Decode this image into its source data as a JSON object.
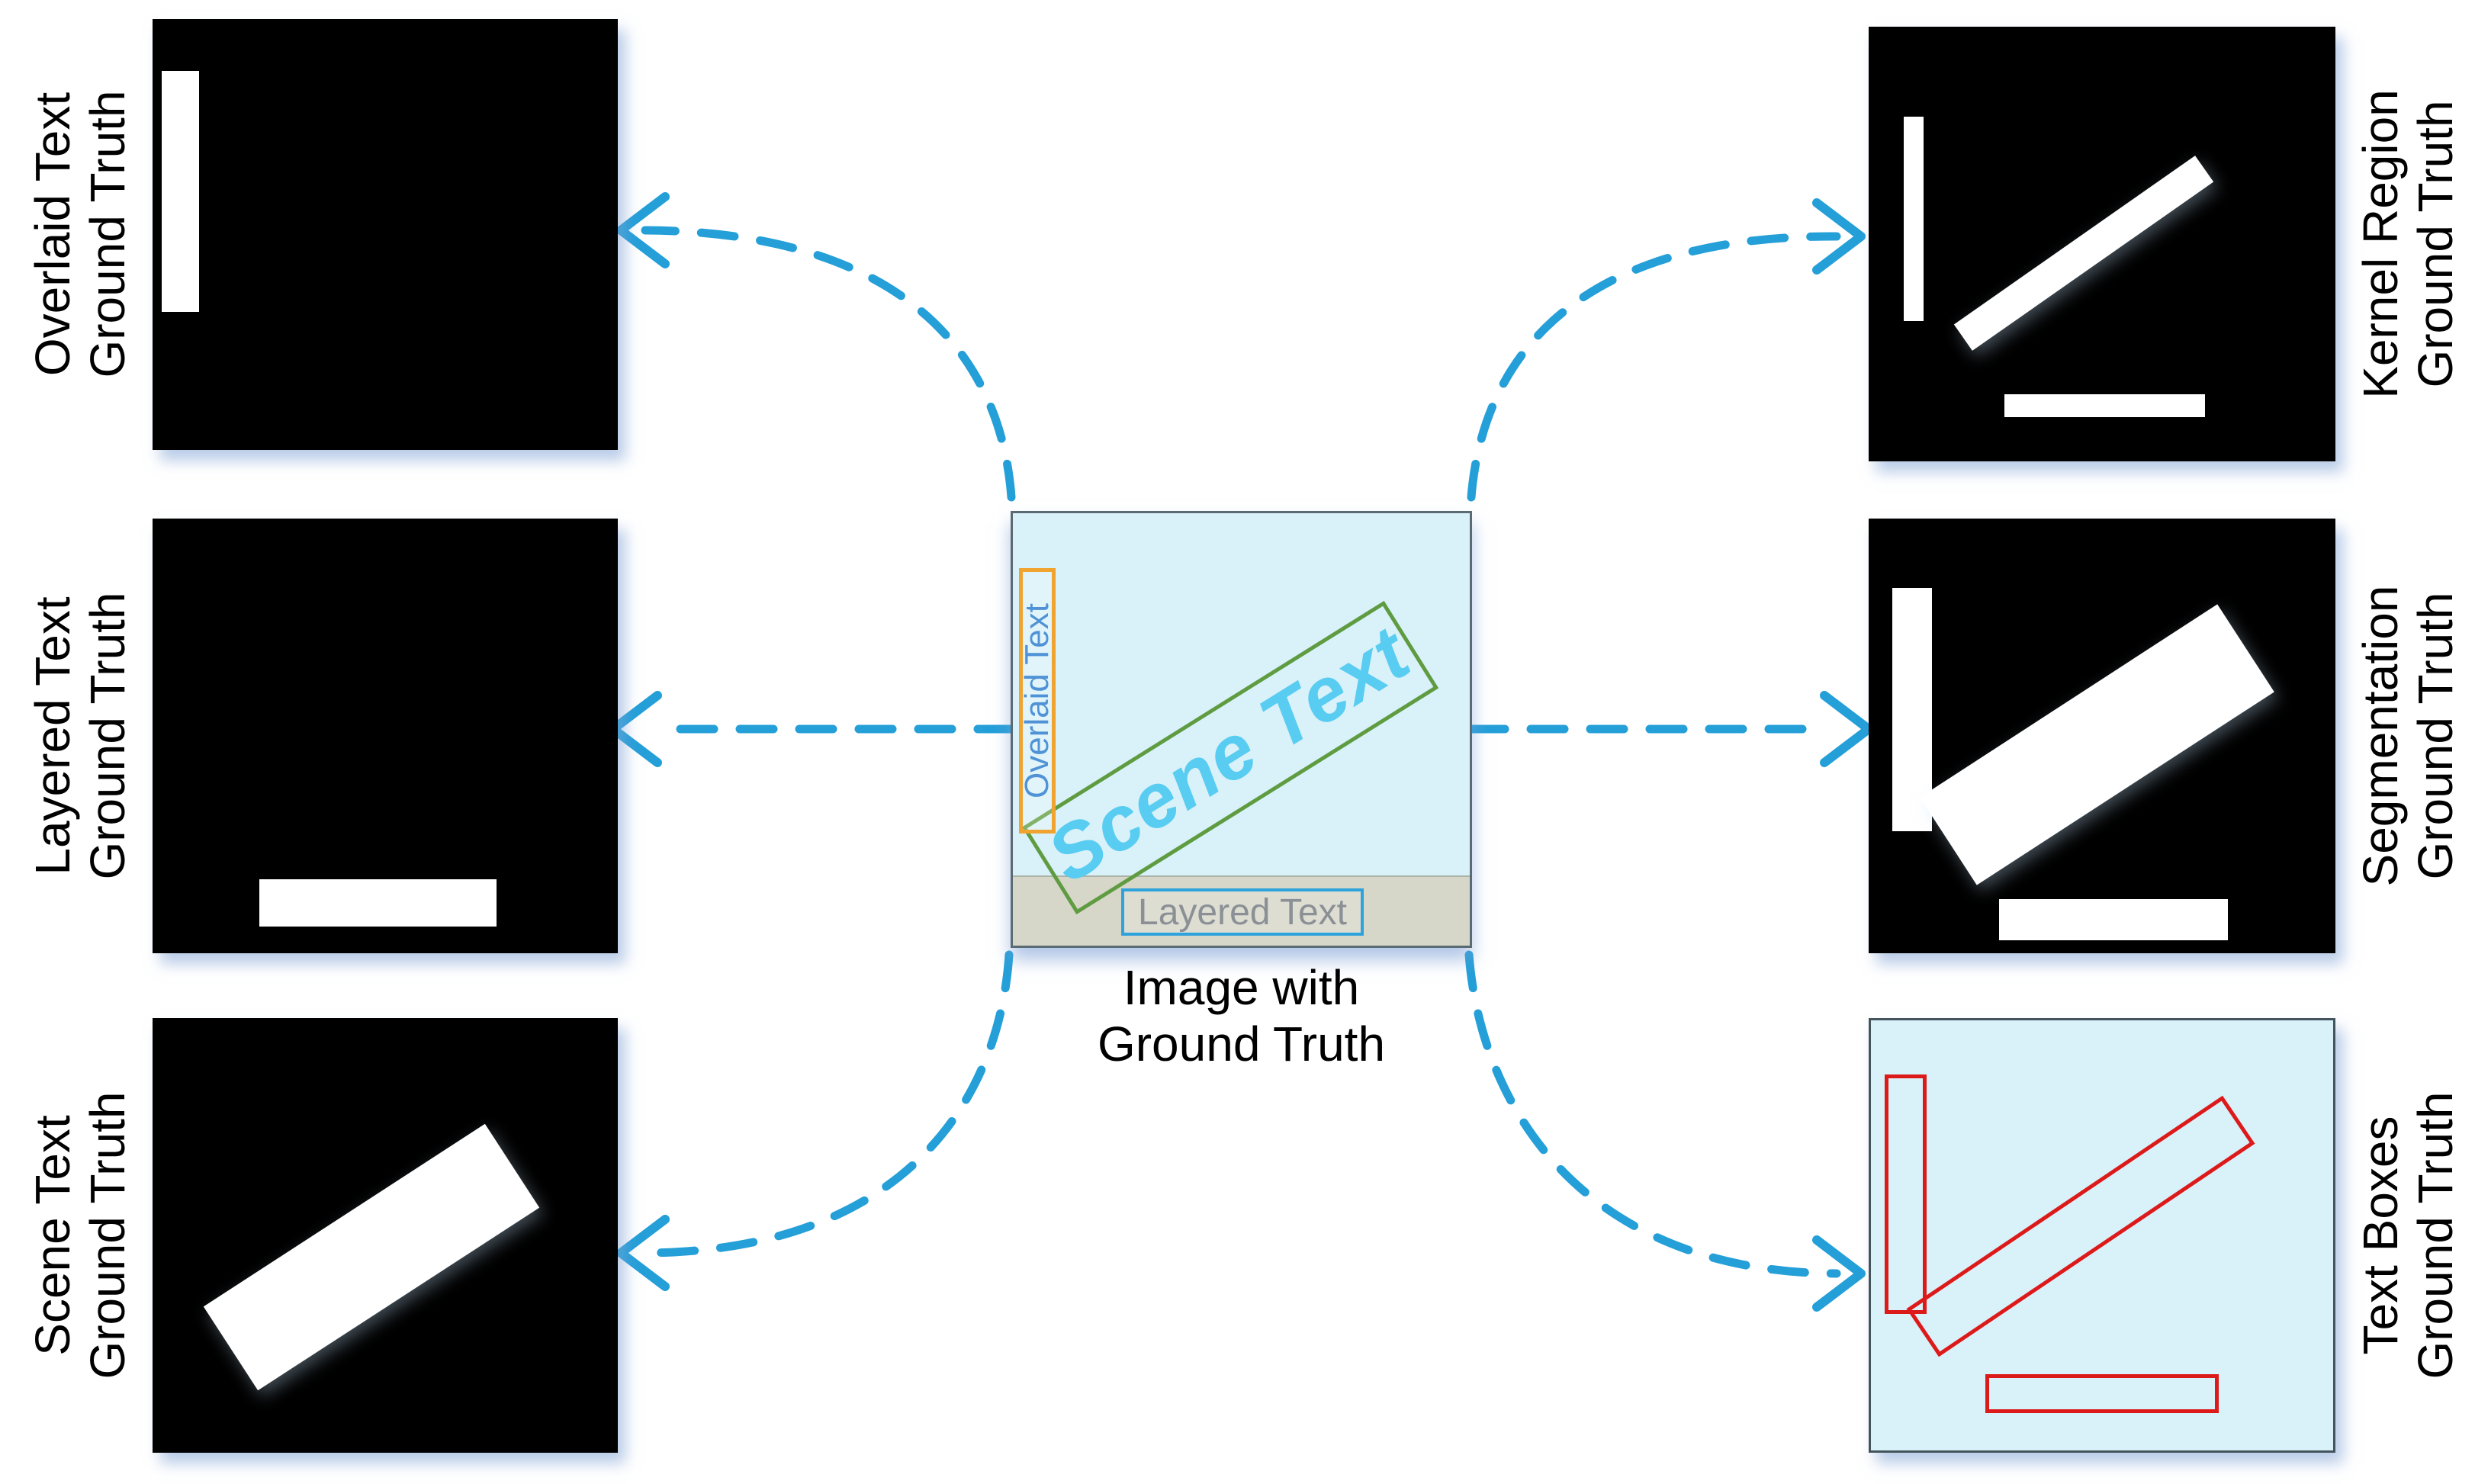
{
  "figure": {
    "caption": "Image with\nGround Truth"
  },
  "side_panels": [
    {
      "id": "overlaid-text-gt",
      "side": "left",
      "label": "Overlaid Text\nGround Truth"
    },
    {
      "id": "layered-text-gt",
      "side": "left",
      "label": "Layered Text\nGround Truth"
    },
    {
      "id": "scene-text-gt",
      "side": "left",
      "label": "Scene Text\nGround Truth"
    },
    {
      "id": "kernel-region-gt",
      "side": "right",
      "label": "Kernel Region\nGround Truth"
    },
    {
      "id": "segmentation-gt",
      "side": "right",
      "label": "Segmentation\nGround Truth"
    },
    {
      "id": "text-boxes-gt",
      "side": "right",
      "label": "Text Boxes\nGround Truth"
    }
  ],
  "center_image": {
    "overlaid_text_tag": "Overlaid Text",
    "scene_text_tag": "Scene Text",
    "layered_text_tag": "Layered Text"
  },
  "arrows": {
    "style": "dashed",
    "items": [
      "center-to-overlaid-gt-arrow",
      "center-to-layered-gt-arrow",
      "center-to-scene-gt-arrow",
      "center-to-kernel-gt-arrow",
      "center-to-segmentation-gt-arrow",
      "center-to-textboxes-gt-arrow"
    ]
  },
  "colors": {
    "arrow_blue": "#249fd8",
    "panel_black": "#000000",
    "mask_white": "#ffffff",
    "image_background": "#d9f1f9",
    "overlaid_box_border": "#f0a32f",
    "overlaid_text_color": "#4f93d6",
    "scene_box_border": "#5f9c41",
    "scene_text_color": "#58cdf1",
    "layered_strip": "#d7d7c9",
    "layered_box_border": "#2ea2db",
    "layered_text_color": "#8a9095",
    "text_box_red": "#dd1a1a"
  }
}
